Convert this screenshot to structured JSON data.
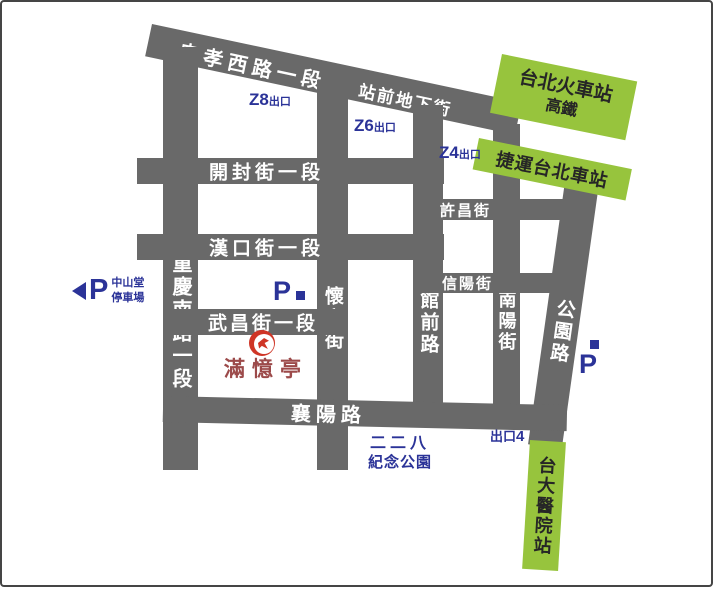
{
  "map": {
    "streets": {
      "zhongxiao_w_rd": "忠孝西路一段",
      "station_front_mall": "站前地下街",
      "kaifeng_st": "開封街一段",
      "hankou_st": "漢口街一段",
      "wuchang_st": "武昌街一段",
      "xiangyang_rd": "襄陽路",
      "chongqing_s_rd": "重慶南路一段",
      "huaining_st": "懷寧街",
      "guanqian_rd": "館前路",
      "nanyang_st": "南陽街",
      "xuchang_st": "許昌街",
      "xinyang_st": "信陽街",
      "gongyuan_rd": "公園路"
    },
    "stations": {
      "main_station_line1": "台北火車站",
      "main_station_line2": "高鐵",
      "mrt_station": "捷運台北車站",
      "ntuh_station": "台大醫院站"
    },
    "exits": {
      "z8": "Z8",
      "z6": "Z6",
      "z4": "Z4",
      "exit_suffix": "出口",
      "exit4_prefix": "出口",
      "exit4_num": "4"
    },
    "parking": {
      "p": "P",
      "zhongshan_line1": "中山堂",
      "zhongshan_line2": "停車場"
    },
    "park": {
      "line1": "二二八",
      "line2": "紀念公園"
    },
    "restaurant": {
      "name": "滿憶亭"
    },
    "colors": {
      "street_gray": "#696969",
      "station_green": "#97c43d",
      "label_blue": "#2b3398",
      "logo_red": "#cf3526",
      "restaurant_red": "#9c4a4a",
      "street_text": "#ffffff",
      "station_text": "#262626"
    }
  }
}
